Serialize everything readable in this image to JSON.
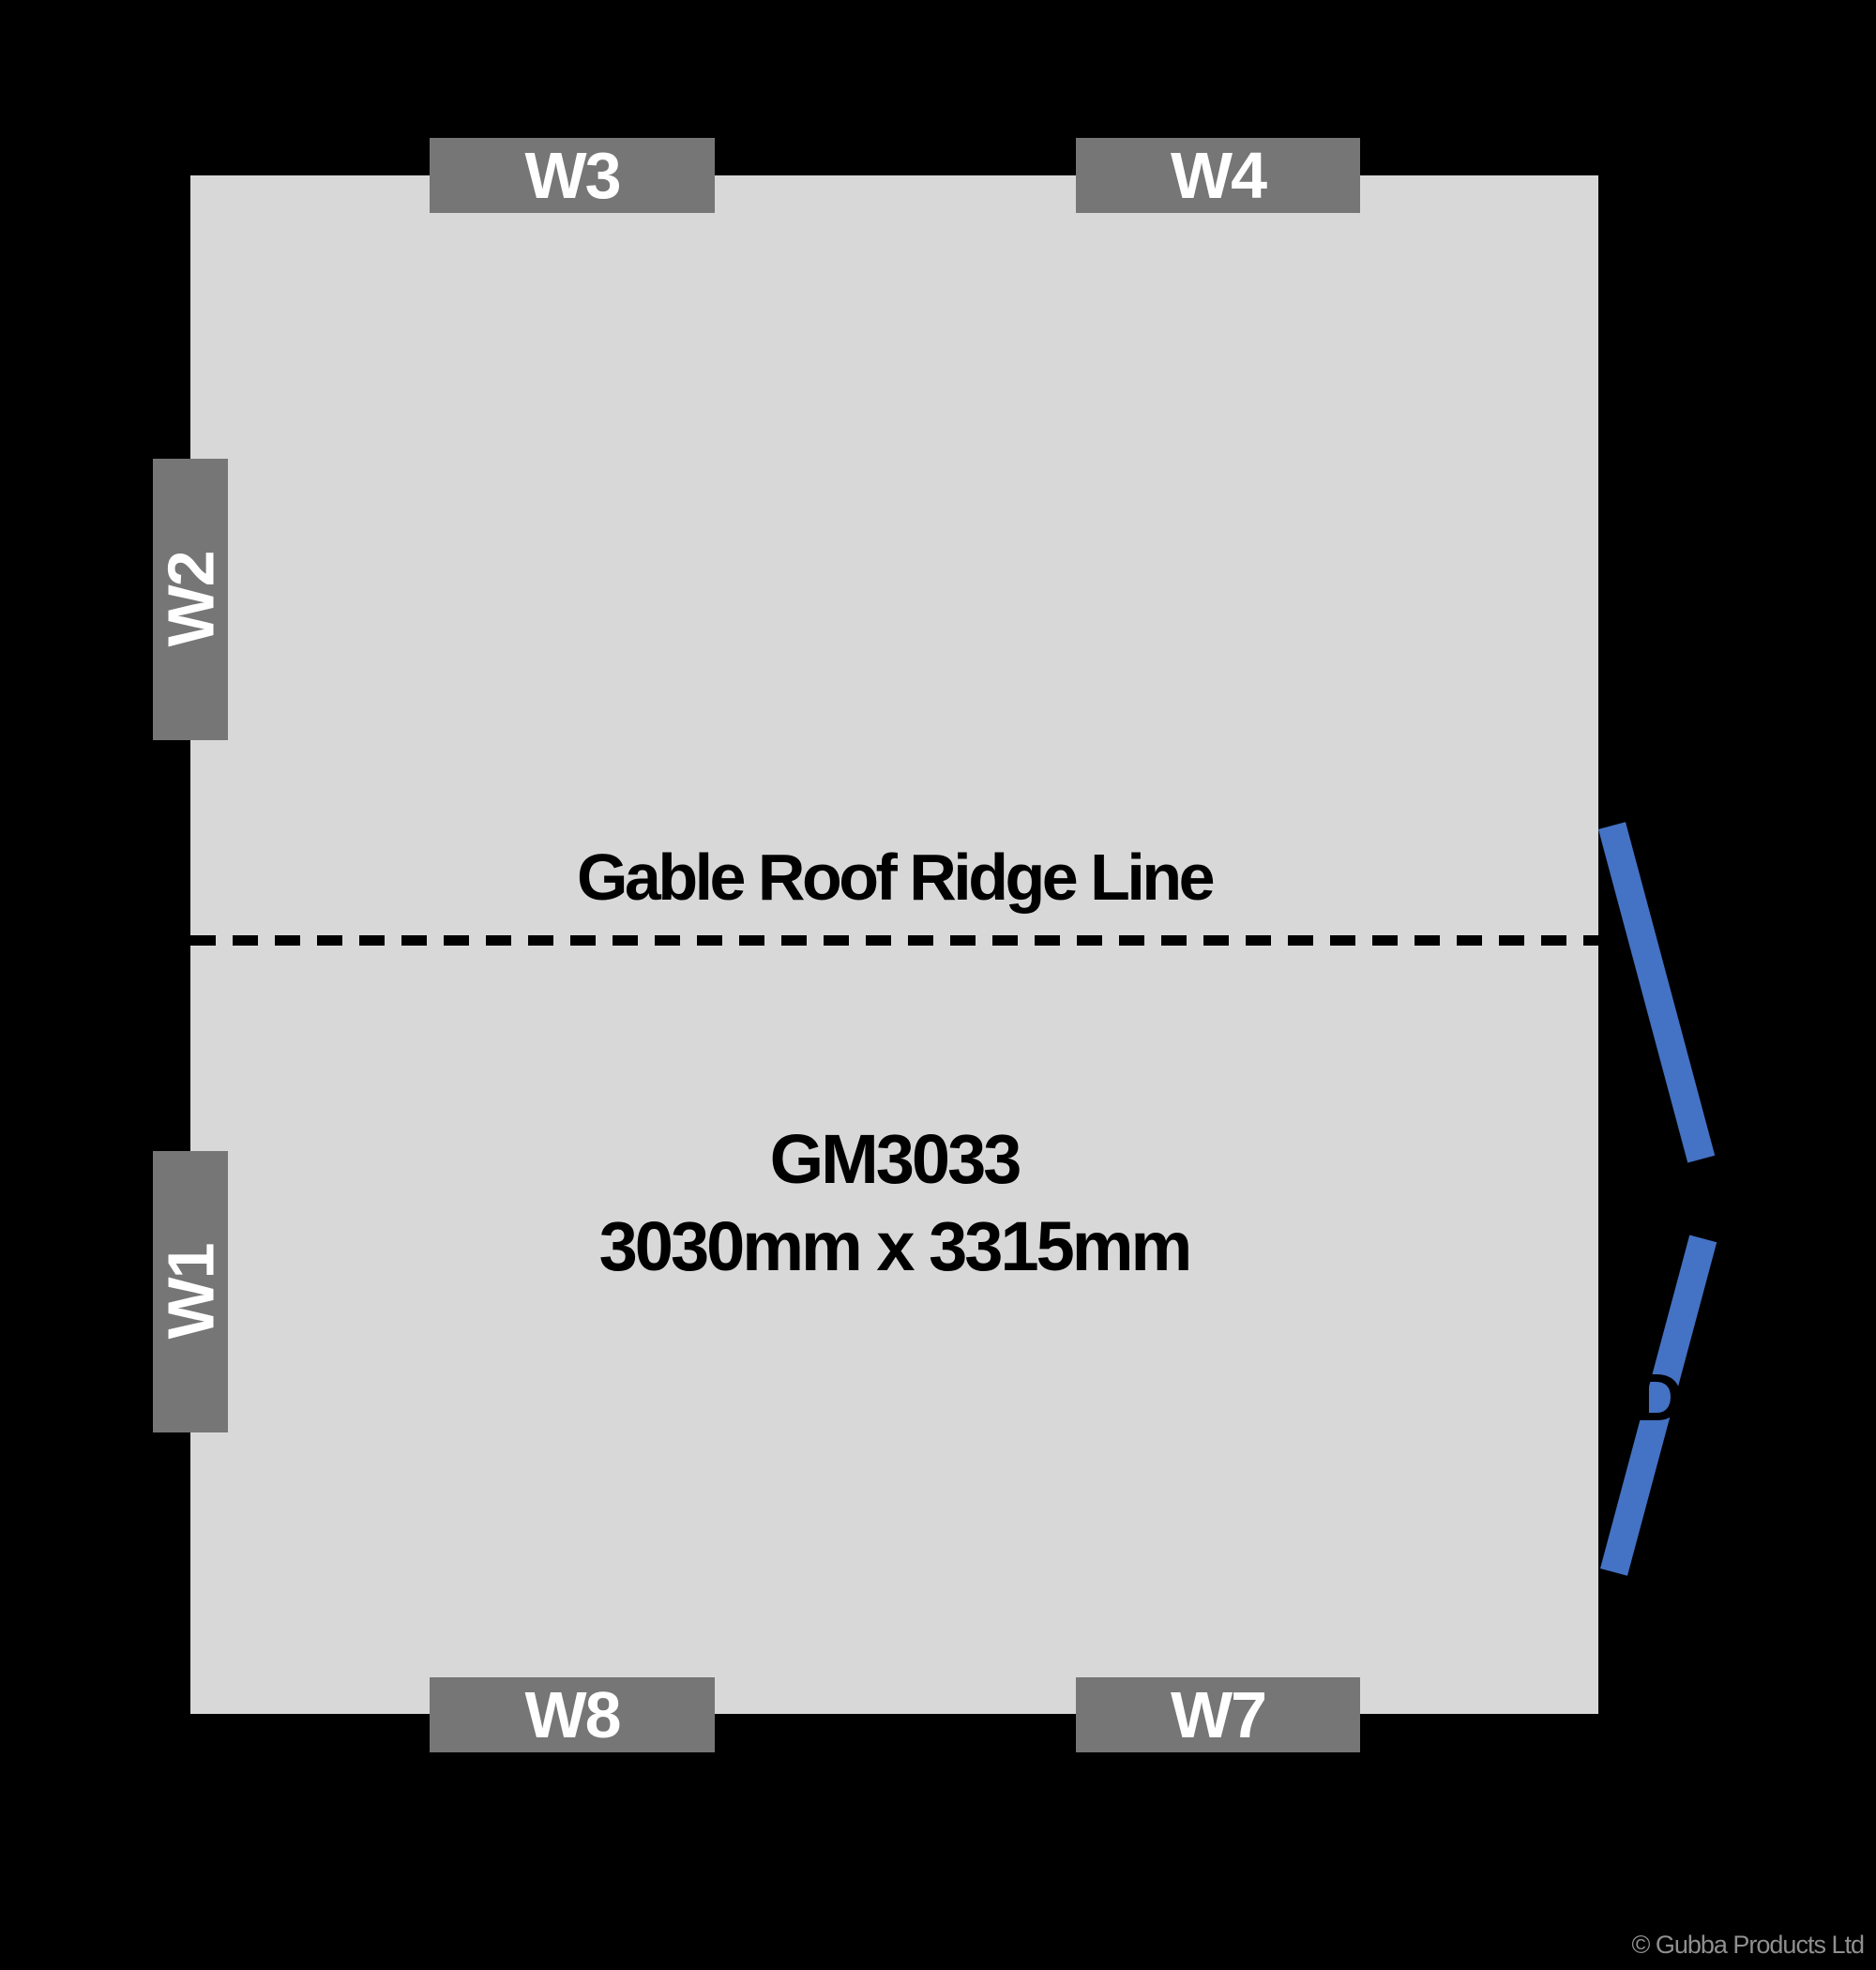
{
  "plan": {
    "model": "GM3033",
    "size": "3030mm x 3315mm",
    "ridge_label": "Gable Roof Ridge Line"
  },
  "windows": [
    {
      "id": "W1",
      "wall": "left"
    },
    {
      "id": "W2",
      "wall": "left"
    },
    {
      "id": "W3",
      "wall": "top"
    },
    {
      "id": "W4",
      "wall": "top"
    },
    {
      "id": "W7",
      "wall": "bottom"
    },
    {
      "id": "W8",
      "wall": "bottom"
    }
  ],
  "door": {
    "label": "D",
    "wall": "right",
    "type": "double-door-open"
  },
  "footer": {
    "copyright": "© Gubba Products Ltd"
  },
  "colors": {
    "background": "#000000",
    "floor": "#d8d8d8",
    "window_block": "#767676",
    "window_text": "#ffffff",
    "door_blue": "#4472c4",
    "plan_text": "#000000",
    "copyright_text": "#8f8f8f"
  }
}
